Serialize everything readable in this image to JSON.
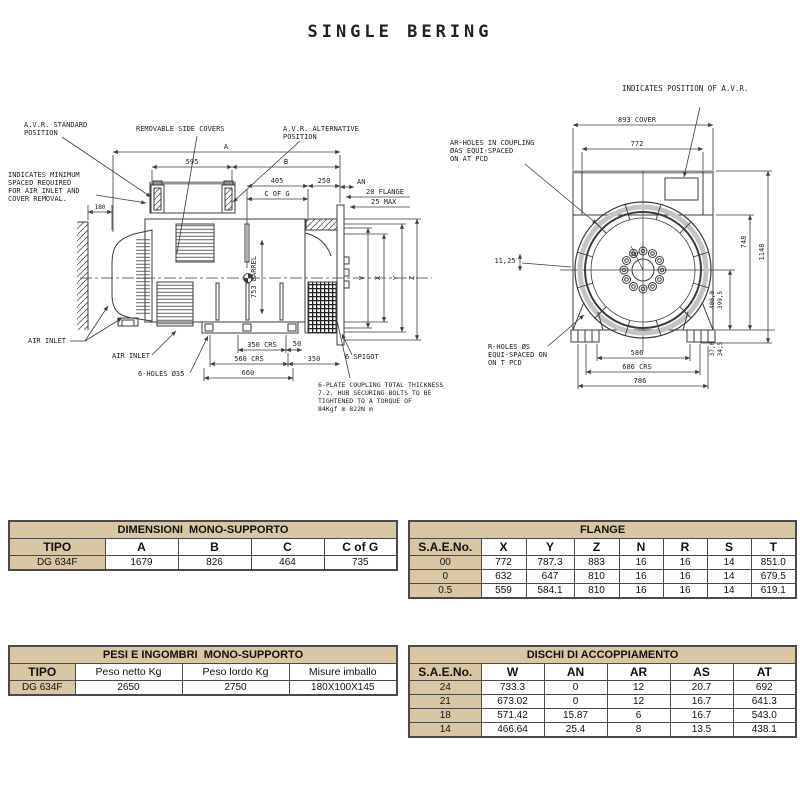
{
  "page": {
    "title": "SINGLE BERING"
  },
  "side_view": {
    "callouts": {
      "avr_standard": [
        "A.V.R. STANDARD",
        "POSITION"
      ],
      "removable_covers": "REMOVABLE SIDE COVERS",
      "avr_alternative": [
        "A.V.R. ALTERNATIVE",
        "POSITION"
      ],
      "min_space": [
        "INDICATES MINIMUM",
        "SPACED REQUIRED",
        "FOR AIR INLET AND",
        "COVER REMOVAL."
      ],
      "air_inlet_left": "AIR INLET",
      "air_inlet_bottom": "AIR INLET",
      "holes": "6-HOLES Ø35",
      "spigot": "6 SPIGOT",
      "coupling_note": [
        "6-PLATE COUPLING TOTAL THICKNESS",
        "7.2. HUB SECURING BOLTS TO BE",
        "TIGHTENED TO A TORQUE OF",
        "84Kgf m 822N m"
      ]
    },
    "dims": {
      "a": "A",
      "b": "B",
      "d595": "595",
      "d405": "405",
      "d250": "250",
      "an": "AN",
      "cofg": "C OF G",
      "flange20": "20 FLANGE",
      "max25": "25 MAX",
      "d180": "180",
      "barrel": "753 BARREL",
      "crs350": "350 CRS",
      "d50": "50",
      "crs560": "560 CRS",
      "d350": "350",
      "d660": "660",
      "v": "V",
      "x": "X",
      "y": "Y",
      "z": "Z"
    }
  },
  "front_view": {
    "callouts": {
      "avr_position": "INDICATES POSITION OF A.V.R.",
      "ar_holes": [
        "AR-HOLES IN COUPLING",
        "ØAS EQUI-SPACED",
        "ON AT PCD"
      ],
      "r_holes": [
        "R-HOLES ØS",
        "EQUI-SPACED ON",
        "ON T PCD"
      ]
    },
    "dims": {
      "cover893": "893 COVER",
      "d772": "772",
      "d748": "748",
      "d1148": "1148",
      "d400": "400,0",
      "d399": "399,5",
      "d37": "37,0",
      "d34": "34,5",
      "d586": "586",
      "crs686": "686 CRS",
      "d786": "786",
      "d1125": "11,25",
      "a30": "30°"
    }
  },
  "tables": {
    "dimensioni": {
      "title": "DIMENSIONI  MONO-SUPPORTO",
      "headers": [
        "TIPO",
        "A",
        "B",
        "C",
        "C of G"
      ],
      "rows": [
        [
          "DG 634F",
          "1679",
          "826",
          "464",
          "735"
        ]
      ]
    },
    "flange": {
      "title": "FLANGE",
      "headers": [
        "S.A.E.No.",
        "X",
        "Y",
        "Z",
        "N",
        "R",
        "S",
        "T"
      ],
      "rows": [
        [
          "00",
          "772",
          "787.3",
          "883",
          "16",
          "16",
          "14",
          "851.0"
        ],
        [
          "0",
          "632",
          "647",
          "810",
          "16",
          "16",
          "14",
          "679.5"
        ],
        [
          "0.5",
          "559",
          "584.1",
          "810",
          "16",
          "16",
          "14",
          "619.1"
        ]
      ]
    },
    "pesi": {
      "title": "PESI E INGOMBRI  MONO-SUPPORTO",
      "headers": [
        "TIPO",
        "Peso netto Kg",
        "Peso lordo Kg",
        "Misure imballo"
      ],
      "rows": [
        [
          "DG 634F",
          "2650",
          "2750",
          "180X100X145"
        ]
      ]
    },
    "dischi": {
      "title": "DISCHI DI ACCOPPIAMENTO",
      "headers": [
        "S.A.E.No.",
        "W",
        "AN",
        "AR",
        "AS",
        "AT"
      ],
      "rows": [
        [
          "24",
          "733.3",
          "0",
          "12",
          "20.7",
          "692"
        ],
        [
          "21",
          "673.02",
          "0",
          "12",
          "16.7",
          "641.3"
        ],
        [
          "18",
          "571.42",
          "15.87",
          "6",
          "16.7",
          "543.0"
        ],
        [
          "14",
          "466.64",
          "25.4",
          "8",
          "13.5",
          "438.1"
        ]
      ]
    }
  },
  "colors": {
    "accent_tan": "#d9c6a5",
    "line": "#3c3c3c",
    "gray_band": "#c4c4c4"
  }
}
